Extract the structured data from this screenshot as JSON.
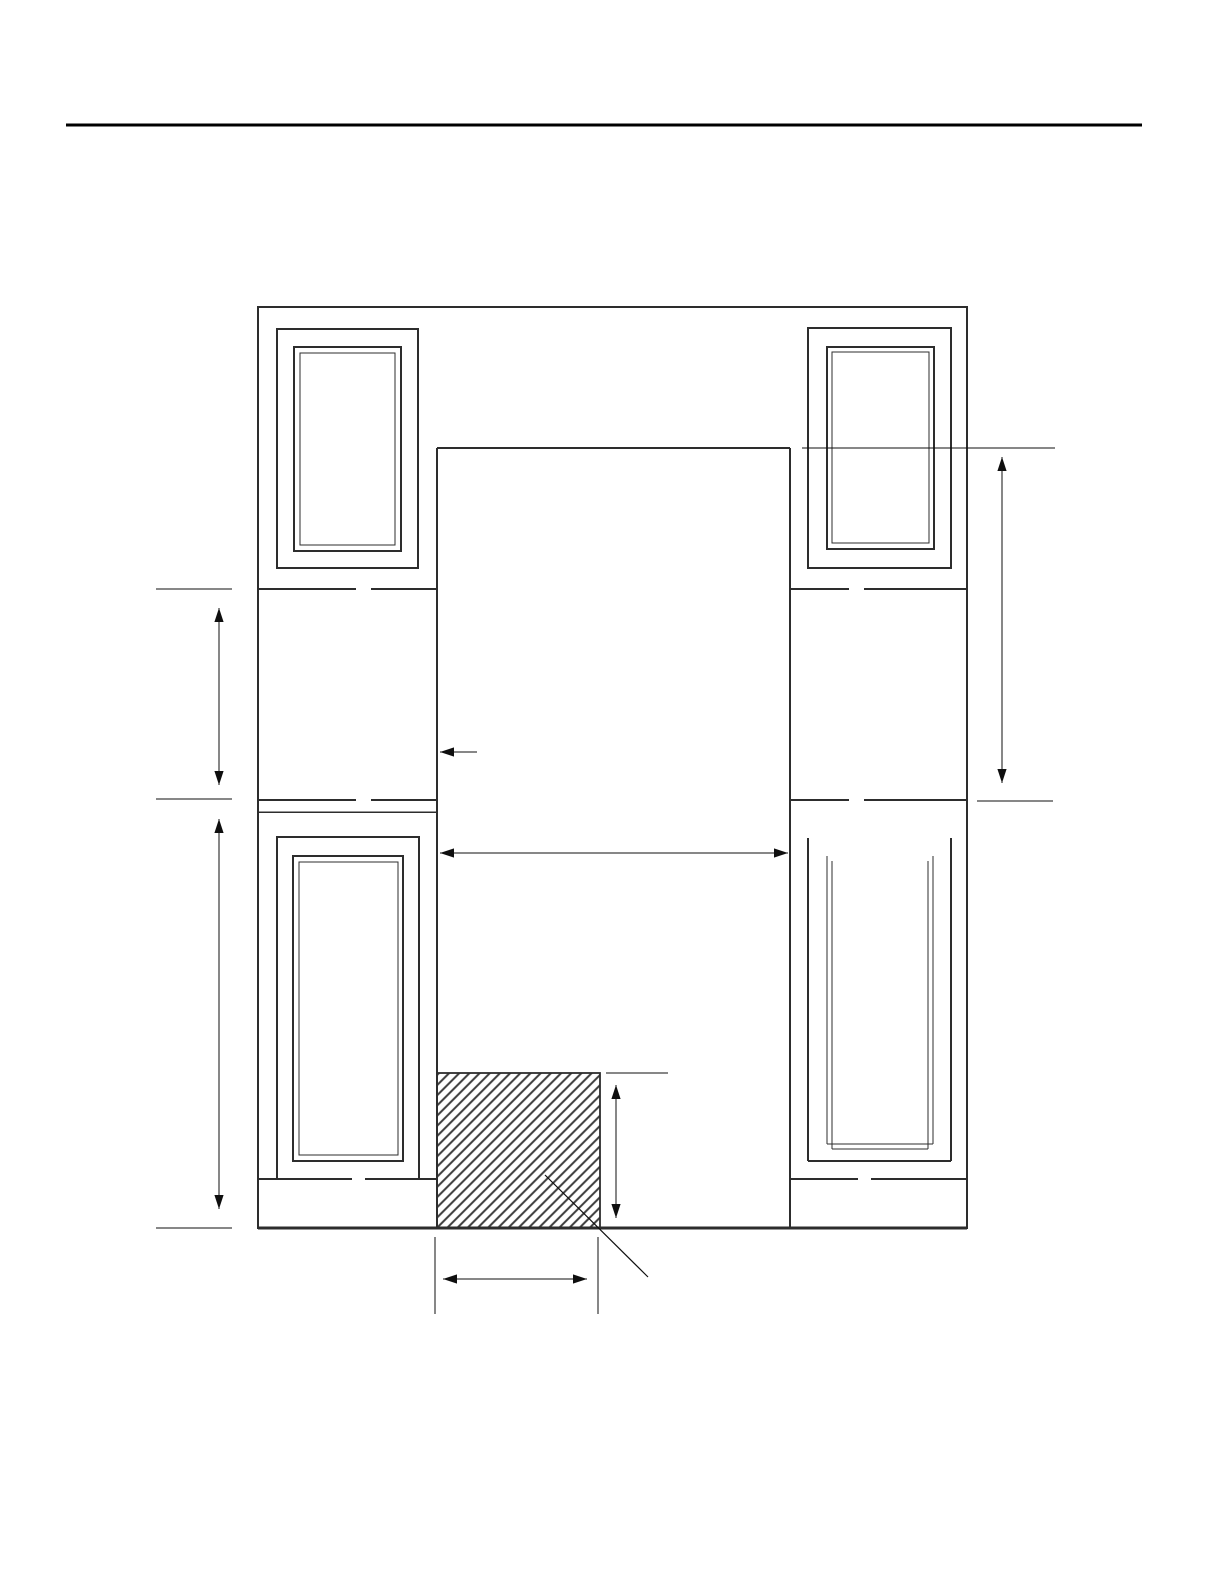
{
  "page": {
    "width": 1224,
    "height": 1584,
    "background": "#ffffff"
  },
  "header": {
    "rule": {
      "x1": 66,
      "y1": 125,
      "x2": 1142,
      "y2": 125,
      "sw": 2.6,
      "color": "#000000"
    }
  },
  "figure": {
    "viewbox": [
      0,
      0,
      1224,
      1584
    ],
    "styles": {
      "line_color": "#2d2d2d",
      "dim_color": "#0f0f0f",
      "hatch_color": "#3b3b3b",
      "notch_color": "#ffffff",
      "arrow_head_length": 14,
      "arrow_head_halfwidth": 4.6
    },
    "rects": [
      {
        "name": "cabinet-outer-outline",
        "x": 258,
        "y": 307,
        "w": 709,
        "h": 921,
        "sw": 2
      },
      {
        "name": "top-left-door-outer-frame",
        "x": 277,
        "y": 329,
        "w": 141,
        "h": 239,
        "sw": 2
      },
      {
        "name": "top-left-door-inner-frame",
        "x": 294,
        "y": 347,
        "w": 107,
        "h": 204,
        "sw": 1.7
      },
      {
        "name": "top-left-door-bevel-frame",
        "x": 300,
        "y": 353,
        "w": 95,
        "h": 192,
        "sw": 1
      },
      {
        "name": "top-right-door-outer-frame",
        "x": 808,
        "y": 328,
        "w": 143,
        "h": 240,
        "sw": 2
      },
      {
        "name": "top-right-door-inner-frame",
        "x": 827,
        "y": 347,
        "w": 107,
        "h": 202,
        "sw": 1.7
      },
      {
        "name": "top-right-door-bevel-frame",
        "x": 832,
        "y": 352,
        "w": 97,
        "h": 191,
        "sw": 1
      },
      {
        "name": "bottom-left-door-outer-frame",
        "x": 277,
        "y": 837,
        "w": 142,
        "h": 342,
        "sw": 2
      },
      {
        "name": "bottom-left-door-inner-frame",
        "x": 293,
        "y": 856,
        "w": 110,
        "h": 305,
        "sw": 1.7
      },
      {
        "name": "bottom-left-door-bevel-frame",
        "x": 299,
        "y": 862,
        "w": 99,
        "h": 293,
        "sw": 1
      }
    ],
    "hatch": {
      "name": "hatched-cutout-region",
      "x": 437,
      "y": 1073,
      "w": 163,
      "h": 155,
      "tile": 7.2,
      "sw": 2,
      "border_sw": 1.8
    },
    "lines": [
      {
        "name": "cutout-left-edge",
        "x1": 437,
        "y1": 448,
        "x2": 437,
        "y2": 1228,
        "sw": 2.2
      },
      {
        "name": "cutout-right-edge",
        "x1": 790,
        "y1": 448,
        "x2": 790,
        "y2": 1228,
        "sw": 2.2
      },
      {
        "name": "cutout-top-edge",
        "x1": 437,
        "y1": 448,
        "x2": 790,
        "y2": 448,
        "sw": 2
      },
      {
        "name": "left-rail-top-line",
        "x1": 258,
        "y1": 589,
        "x2": 437,
        "y2": 589,
        "sw": 2
      },
      {
        "name": "right-rail-top-line",
        "x1": 790,
        "y1": 589,
        "x2": 967,
        "y2": 589,
        "sw": 2
      },
      {
        "name": "left-rail-bottom-line-upper",
        "x1": 258,
        "y1": 800,
        "x2": 437,
        "y2": 800,
        "sw": 2
      },
      {
        "name": "left-rail-bottom-line-lower",
        "x1": 258,
        "y1": 812,
        "x2": 437,
        "y2": 812,
        "sw": 1.5
      },
      {
        "name": "right-rail-bottom-line",
        "x1": 790,
        "y1": 800,
        "x2": 967,
        "y2": 800,
        "sw": 2
      },
      {
        "name": "left-toe-kick-line",
        "x1": 258,
        "y1": 1179,
        "x2": 437,
        "y2": 1179,
        "sw": 2
      },
      {
        "name": "right-toe-kick-line",
        "x1": 790,
        "y1": 1179,
        "x2": 967,
        "y2": 1179,
        "sw": 2
      },
      {
        "name": "cabinet-bottom-edge",
        "x1": 258,
        "y1": 1228,
        "x2": 967,
        "y2": 1228,
        "sw": 3
      },
      {
        "name": "bottom-right-door-stile-outer-left",
        "x1": 808,
        "y1": 838,
        "x2": 808,
        "y2": 1161,
        "sw": 1.8
      },
      {
        "name": "bottom-right-door-stile-inner-left-a",
        "x1": 827,
        "y1": 856,
        "x2": 827,
        "y2": 1144,
        "sw": 1.4
      },
      {
        "name": "bottom-right-door-stile-inner-left-b",
        "x1": 832,
        "y1": 861,
        "x2": 832,
        "y2": 1149,
        "sw": 1.2
      },
      {
        "name": "bottom-right-door-stile-inner-right-b",
        "x1": 928,
        "y1": 861,
        "x2": 928,
        "y2": 1149,
        "sw": 1.2
      },
      {
        "name": "bottom-right-door-stile-inner-right-a",
        "x1": 933,
        "y1": 856,
        "x2": 933,
        "y2": 1144,
        "sw": 1.4
      },
      {
        "name": "bottom-right-door-stile-outer-right",
        "x1": 951,
        "y1": 838,
        "x2": 951,
        "y2": 1161,
        "sw": 1.8
      },
      {
        "name": "bottom-right-door-bottom-rail-line",
        "x1": 808,
        "y1": 1161,
        "x2": 951,
        "y2": 1161,
        "sw": 1.8
      },
      {
        "name": "bottom-right-door-bevel-bottom-a",
        "x1": 827,
        "y1": 1144,
        "x2": 933,
        "y2": 1144,
        "sw": 1.4
      },
      {
        "name": "bottom-right-door-bevel-bottom-b",
        "x1": 832,
        "y1": 1149,
        "x2": 928,
        "y2": 1149,
        "sw": 1.2
      }
    ],
    "notches": [
      {
        "name": "line-gap-notch",
        "x": 356,
        "y": 586,
        "w": 15,
        "h": 6
      },
      {
        "name": "line-gap-notch",
        "x": 356,
        "y": 797,
        "w": 15,
        "h": 6
      },
      {
        "name": "line-gap-notch",
        "x": 849,
        "y": 586,
        "w": 15,
        "h": 6
      },
      {
        "name": "line-gap-notch",
        "x": 849,
        "y": 797,
        "w": 15,
        "h": 6
      },
      {
        "name": "line-gap-notch",
        "x": 352,
        "y": 1176,
        "w": 13,
        "h": 5
      },
      {
        "name": "line-gap-notch",
        "x": 858,
        "y": 1176,
        "w": 13,
        "h": 5
      }
    ],
    "dim_lines": [
      {
        "name": "ext-line-left-upper",
        "x1": 156,
        "y1": 589,
        "x2": 232,
        "y2": 589,
        "sw": 1.3
      },
      {
        "name": "ext-line-left-middle",
        "x1": 156,
        "y1": 799,
        "x2": 232,
        "y2": 799,
        "sw": 1.3
      },
      {
        "name": "ext-line-left-bottom",
        "x1": 156,
        "y1": 1228,
        "x2": 232,
        "y2": 1228,
        "sw": 1.3
      },
      {
        "name": "ext-line-right-upper",
        "x1": 802,
        "y1": 448,
        "x2": 1055,
        "y2": 448,
        "sw": 1.3
      },
      {
        "name": "ext-line-right-lower",
        "x1": 977,
        "y1": 801,
        "x2": 1053,
        "y2": 801,
        "sw": 1.3
      },
      {
        "name": "ext-line-hatch-top",
        "x1": 606,
        "y1": 1073,
        "x2": 668,
        "y2": 1073,
        "sw": 1.3
      },
      {
        "name": "ext-line-hatch-bottom-left",
        "x1": 435,
        "y1": 1237,
        "x2": 435,
        "y2": 1314,
        "sw": 1.3
      },
      {
        "name": "ext-line-hatch-bottom-right",
        "x1": 598,
        "y1": 1237,
        "x2": 598,
        "y2": 1314,
        "sw": 1.3
      },
      {
        "name": "hatch-leader-line",
        "x1": 545,
        "y1": 1175,
        "x2": 648,
        "y2": 1277,
        "sw": 1.2
      }
    ],
    "arrows": [
      {
        "name": "left-upper-height-arrow",
        "x1": 219,
        "y1": 608,
        "x2": 219,
        "y2": 785,
        "heads": "both",
        "sw": 1.4
      },
      {
        "name": "left-lower-height-arrow",
        "x1": 219,
        "y1": 819,
        "x2": 219,
        "y2": 1209,
        "heads": "both",
        "sw": 1.4
      },
      {
        "name": "right-height-arrow",
        "x1": 1002,
        "y1": 457,
        "x2": 1002,
        "y2": 783,
        "heads": "both",
        "sw": 1.4
      },
      {
        "name": "cutout-width-arrow",
        "x1": 440,
        "y1": 853,
        "x2": 788,
        "y2": 853,
        "heads": "both",
        "sw": 1.4
      },
      {
        "name": "hatch-height-arrow",
        "x1": 616,
        "y1": 1085,
        "x2": 616,
        "y2": 1218,
        "heads": "both",
        "sw": 1.4
      },
      {
        "name": "hatch-width-arrow",
        "x1": 443,
        "y1": 1279,
        "x2": 587,
        "y2": 1279,
        "heads": "both",
        "sw": 1.4
      },
      {
        "name": "cutout-edge-pointer-arrow",
        "x1": 440,
        "y1": 752,
        "x2": 477,
        "y2": 752,
        "heads": "start",
        "sw": 1.4
      }
    ]
  }
}
